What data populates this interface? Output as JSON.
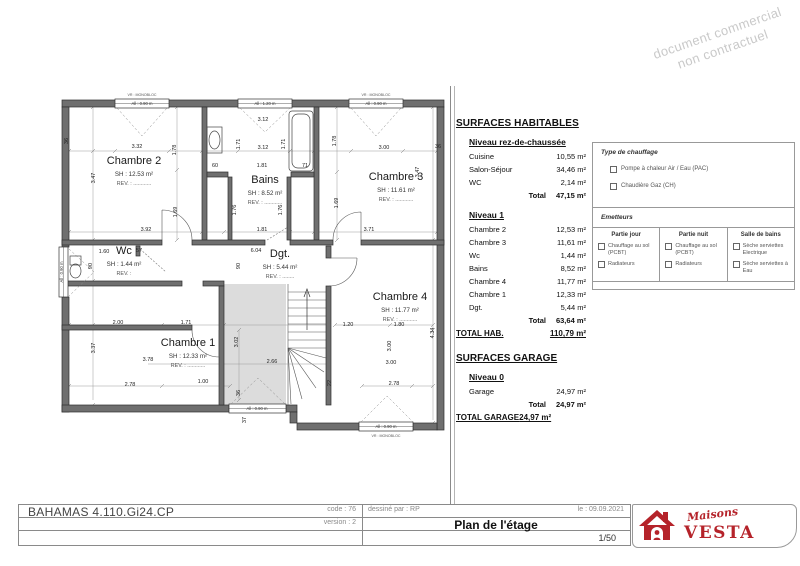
{
  "watermark": {
    "line1": "document commercial",
    "line2": "non contractuel"
  },
  "surfaces": {
    "title": "SURFACES HABITABLES",
    "total_label": "Total",
    "rdc": {
      "heading": "Niveau rez-de-chaussée",
      "rows": [
        {
          "label": "Cuisine",
          "value": "10,55 m²"
        },
        {
          "label": "Salon-Séjour",
          "value": "34,46 m²"
        },
        {
          "label": "WC",
          "value": "2,14 m²"
        }
      ],
      "total": "47,15 m²"
    },
    "n1": {
      "heading": "Niveau 1",
      "rows": [
        {
          "label": "Chambre 2",
          "value": "12,53 m²"
        },
        {
          "label": "Chambre 3",
          "value": "11,61 m²"
        },
        {
          "label": "Wc",
          "value": "1,44 m²"
        },
        {
          "label": "Bains",
          "value": "8,52 m²"
        },
        {
          "label": "Chambre 4",
          "value": "11,77 m²"
        },
        {
          "label": "Chambre 1",
          "value": "12,33 m²"
        },
        {
          "label": "Dgt.",
          "value": "5,44 m²"
        }
      ],
      "total": "63,64 m²",
      "grand_label": "TOTAL HAB.",
      "grand_value": "110,79 m²"
    },
    "garage": {
      "title": "SURFACES GARAGE",
      "heading": "Niveau 0",
      "rows": [
        {
          "label": "Garage",
          "value": "24,97 m²"
        }
      ],
      "total": "24,97 m²",
      "grand_label": "TOTAL GARAGE",
      "grand_value": "24,97 m²"
    }
  },
  "legend": {
    "type_title": "Type de chauffage",
    "type_options": [
      "Pompe à chaleur Air / Eau (PAC)",
      "Chaudière Gaz (CH)"
    ],
    "emetteurs_title": "Emetteurs",
    "columns": [
      {
        "header": "Partie jour",
        "opt1": "Chauffage au sol (PCBT)",
        "opt2": "Radiateurs"
      },
      {
        "header": "Partie nuit",
        "opt1": "Chauffage au sol (PCBT)",
        "opt2": "Radiateurs"
      },
      {
        "header": "Salle de bains",
        "opt1": "Sèche serviettes Electrique",
        "opt2": "Sèche serviettes à Eau"
      }
    ]
  },
  "plan": {
    "rooms": [
      {
        "name": "Chambre 2",
        "sh": "SH : 12.53 m²",
        "rev": "REV. : ............",
        "x": 134,
        "y": 164
      },
      {
        "name": "Bains",
        "sh": "SH : 8.52 m²",
        "rev": "REV. : ............",
        "x": 265,
        "y": 183
      },
      {
        "name": "Chambre 3",
        "sh": "SH : 11.61 m²",
        "rev": "REV. : ............",
        "x": 396,
        "y": 180
      },
      {
        "name": "Wc",
        "sh": "SH : 1.44 m²",
        "rev": "REV. :",
        "x": 124,
        "y": 254
      },
      {
        "name": "Dgt.",
        "sh": "SH : 5.44 m²",
        "rev": "REV. : ........",
        "x": 280,
        "y": 257
      },
      {
        "name": "Chambre 4",
        "sh": "SH : 11.77 m²",
        "rev": "REV. : ............",
        "x": 400,
        "y": 300
      },
      {
        "name": "Chambre 1",
        "sh": "SH : 12.33 m²",
        "rev": "REV. : ............",
        "x": 188,
        "y": 346
      }
    ],
    "dims": [
      {
        "t": "3.32",
        "x": 137,
        "y": 148
      },
      {
        "t": "3.12",
        "x": 263,
        "y": 121
      },
      {
        "t": "3.12",
        "x": 263,
        "y": 149
      },
      {
        "t": "3.00",
        "x": 384,
        "y": 149
      },
      {
        "t": "36",
        "x": 68,
        "y": 141,
        "v": true
      },
      {
        "t": "36",
        "x": 438,
        "y": 148
      },
      {
        "t": "1.78",
        "x": 176,
        "y": 150,
        "v": true
      },
      {
        "t": "1.78",
        "x": 336,
        "y": 141,
        "v": true
      },
      {
        "t": "3.47",
        "x": 95,
        "y": 178,
        "v": true
      },
      {
        "t": "3.47",
        "x": 419,
        "y": 172,
        "v": true
      },
      {
        "t": "1.71",
        "x": 240,
        "y": 144,
        "v": true
      },
      {
        "t": "1.71",
        "x": 285,
        "y": 144,
        "v": true
      },
      {
        "t": "60",
        "x": 215,
        "y": 167
      },
      {
        "t": "1.81",
        "x": 262,
        "y": 167
      },
      {
        "t": "71",
        "x": 305,
        "y": 167
      },
      {
        "t": "1.69",
        "x": 177,
        "y": 212,
        "v": true
      },
      {
        "t": "1.69",
        "x": 338,
        "y": 203,
        "v": true
      },
      {
        "t": "1.76",
        "x": 236,
        "y": 210,
        "v": true
      },
      {
        "t": "1.76",
        "x": 282,
        "y": 210,
        "v": true
      },
      {
        "t": "3.92",
        "x": 146,
        "y": 231
      },
      {
        "t": "1.81",
        "x": 262,
        "y": 231
      },
      {
        "t": "3.71",
        "x": 369,
        "y": 231
      },
      {
        "t": "1.60",
        "x": 104,
        "y": 253
      },
      {
        "t": "57",
        "x": 139,
        "y": 252
      },
      {
        "t": "6.04",
        "x": 256,
        "y": 252
      },
      {
        "t": "90",
        "x": 92,
        "y": 266,
        "v": true
      },
      {
        "t": "90",
        "x": 240,
        "y": 266,
        "v": true
      },
      {
        "t": "2.00",
        "x": 118,
        "y": 324
      },
      {
        "t": "1.71",
        "x": 186,
        "y": 324
      },
      {
        "t": "1.20",
        "x": 348,
        "y": 326
      },
      {
        "t": "1.80",
        "x": 399,
        "y": 326
      },
      {
        "t": "4.34",
        "x": 434,
        "y": 333,
        "v": true
      },
      {
        "t": "3.02",
        "x": 238,
        "y": 342,
        "v": true
      },
      {
        "t": "3.00",
        "x": 391,
        "y": 346,
        "v": true
      },
      {
        "t": "3.37",
        "x": 95,
        "y": 348,
        "v": true
      },
      {
        "t": "3.78",
        "x": 148,
        "y": 361
      },
      {
        "t": "2.66",
        "x": 272,
        "y": 363
      },
      {
        "t": "3.00",
        "x": 391,
        "y": 364
      },
      {
        "t": "1.00",
        "x": 203,
        "y": 383
      },
      {
        "t": "2.78",
        "x": 130,
        "y": 386
      },
      {
        "t": "2.78",
        "x": 394,
        "y": 385
      },
      {
        "t": "22",
        "x": 331,
        "y": 383,
        "v": true
      },
      {
        "t": "36",
        "x": 240,
        "y": 393,
        "v": true
      },
      {
        "t": "37",
        "x": 246,
        "y": 420,
        "v": true
      }
    ],
    "windows": [
      {
        "t": "All : 0.90 m",
        "x": 142,
        "y": 105
      },
      {
        "t": "All : 1.20 m",
        "x": 265,
        "y": 105
      },
      {
        "t": "All : 0.90 m",
        "x": 376,
        "y": 105
      },
      {
        "t": "All : 0.90 m",
        "x": 257,
        "y": 410
      },
      {
        "t": "All : 0.90 m",
        "x": 386,
        "y": 428
      },
      {
        "t": "All : 0.90 m",
        "x": 63,
        "y": 272,
        "v": true
      }
    ],
    "vr": [
      {
        "t": "VR : MONOBLOC",
        "x": 142,
        "y": 96
      },
      {
        "t": "VR : MONOBLOC",
        "x": 376,
        "y": 96
      },
      {
        "t": "VR : MONOBLOC",
        "x": 386,
        "y": 437
      }
    ]
  },
  "titleblock": {
    "project": "BAHAMAS 4.110.Gi24.CP",
    "code": "code : 76",
    "version": "version : 2",
    "drawn_by": "dessiné par : RP",
    "date": "le : 09.09.2021",
    "sheet_title": "Plan de l'étage",
    "scale": "1/50",
    "logo": {
      "script": "Maisons",
      "name": "VESTA",
      "color": "#b5232a"
    }
  }
}
